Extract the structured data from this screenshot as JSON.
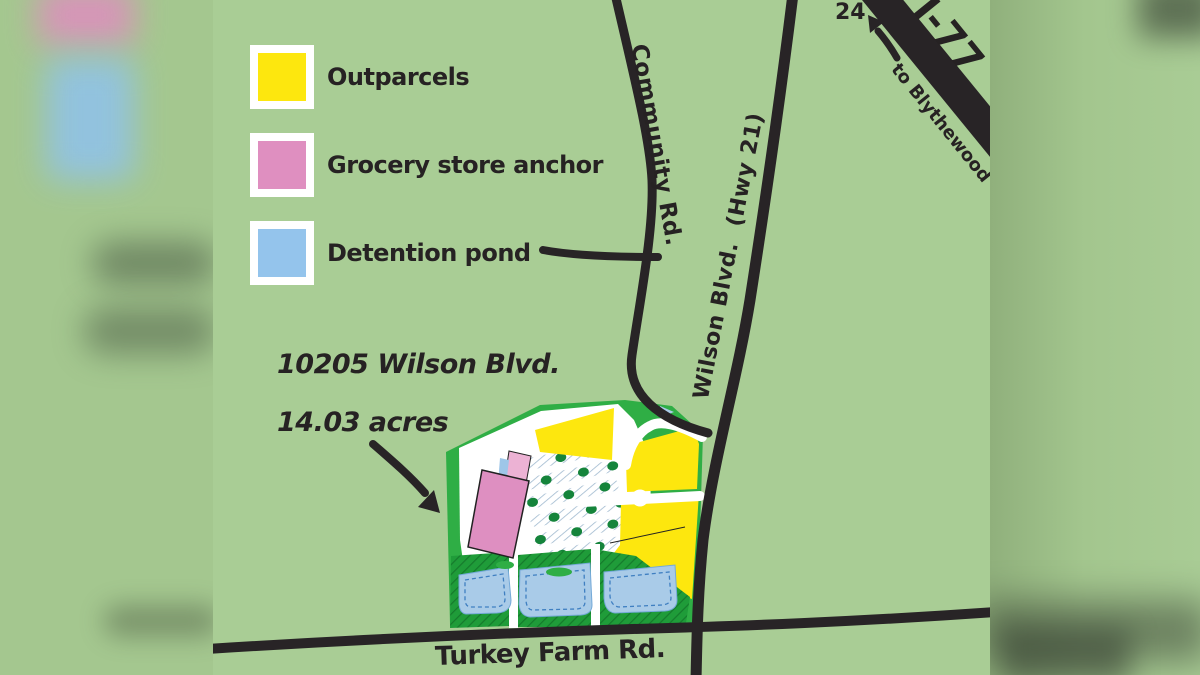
{
  "map": {
    "legend": {
      "items": [
        {
          "id": "outparcels",
          "label": "Outparcels",
          "color": "#FDE70E"
        },
        {
          "id": "grocery-anchor",
          "label": "Grocery store anchor",
          "color": "#DF8FC0"
        },
        {
          "id": "detention-pond",
          "label": "Detention pond",
          "color": "#94C4EC"
        }
      ]
    },
    "annotation": {
      "address": "10205 Wilson Blvd.",
      "area": "14.03 acres"
    },
    "roads": {
      "community": "Community Rd.",
      "wilson": "Wilson Blvd.  (Hwy 21)",
      "turkey_farm": "Turkey Farm Rd.",
      "interstate": "I-77",
      "direction": "to Blythewood",
      "exit_number": "24"
    },
    "colors": {
      "background_green": "#A9CD95",
      "site_green": "#2FAE45",
      "landscape_green": "#1F9C39",
      "tree_green": "#15843B",
      "outparcel_yellow": "#FDE70E",
      "anchor_pink": "#DE8FC1",
      "anchor_pink_light": "#ECB2D4",
      "pond_blue": "#A9CBE8",
      "pond_outline_blue": "#3F7FC1",
      "road_black": "#282426",
      "text_black": "#262223"
    }
  }
}
